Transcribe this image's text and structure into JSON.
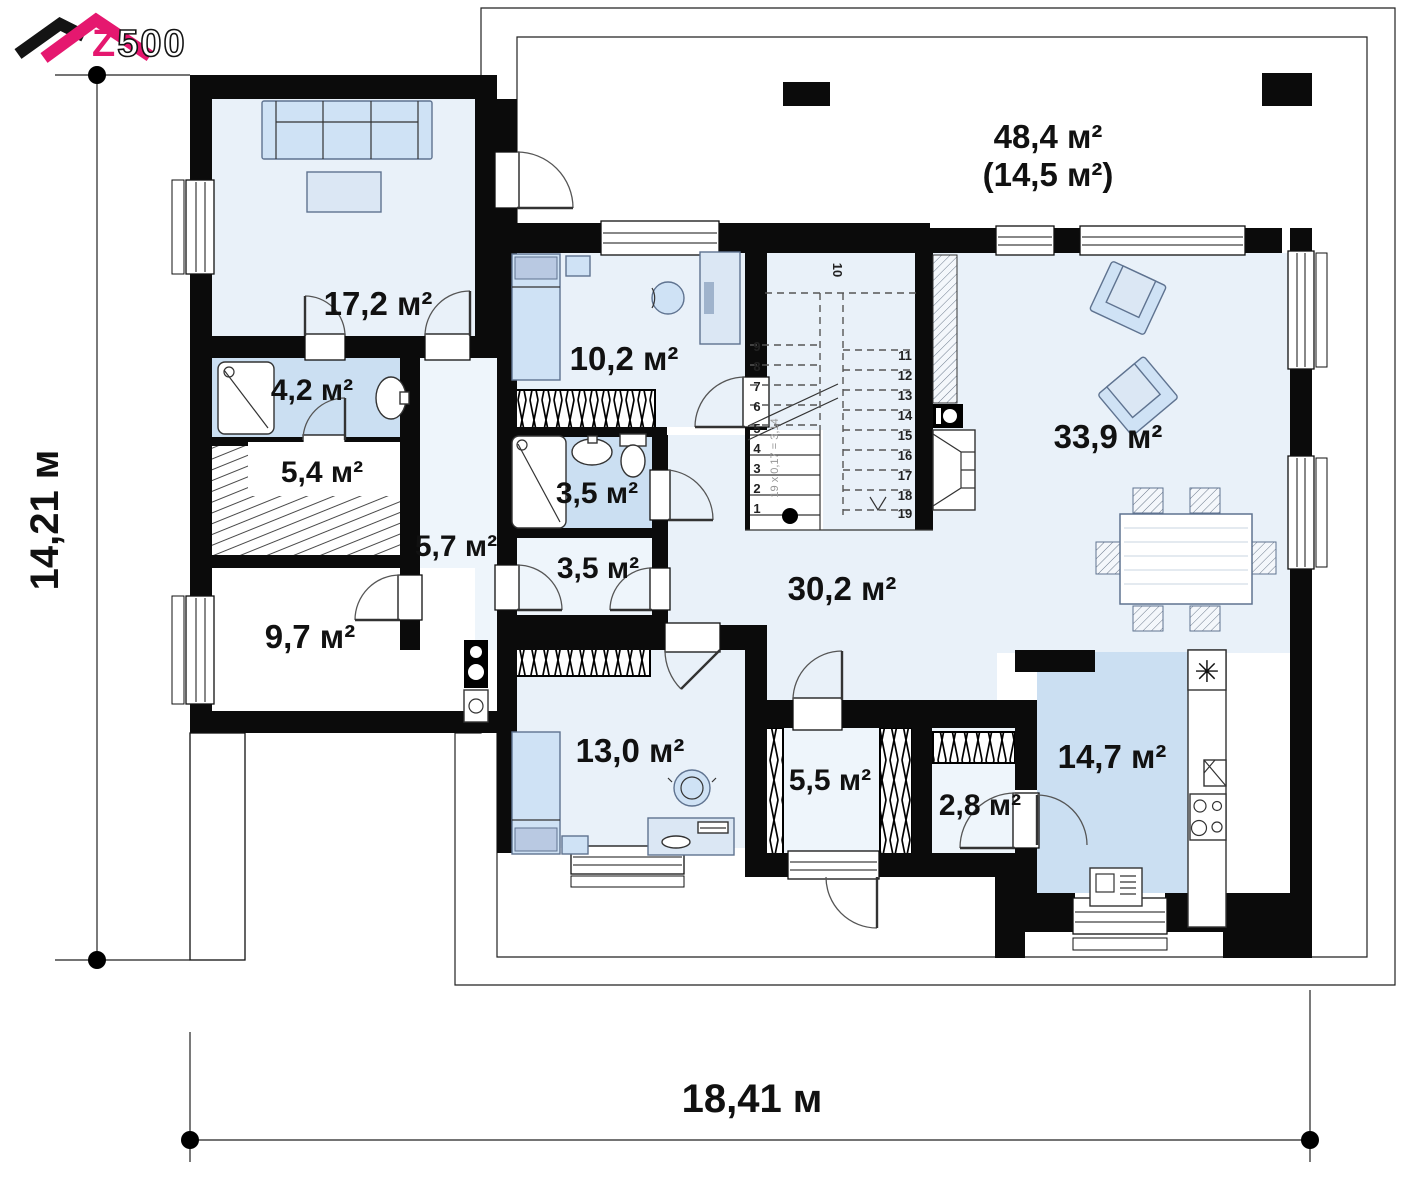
{
  "logo": {
    "brand_z": "Z",
    "brand_rest": "500"
  },
  "plan": {
    "terrace": {
      "area": "48,4 м²",
      "area_in_brackets": "(14,5 м²)"
    },
    "rooms": {
      "room_17_2": {
        "area": "17,2 м²"
      },
      "bath_4_2": {
        "area": "4,2 м²"
      },
      "tech_5_4": {
        "area": "5,4 м²"
      },
      "corridor_5_7": {
        "area": "5,7 м²"
      },
      "room_9_7": {
        "area": "9,7 м²"
      },
      "bedroom_10_2": {
        "area": "10,2 м²"
      },
      "bath_3_5": {
        "area": "3,5 м²"
      },
      "hall_3_5": {
        "area": "3,5 м²"
      },
      "bedroom_13_0": {
        "area": "13,0 м²"
      },
      "hall_30_2": {
        "area": "30,2 м²"
      },
      "living_33_9": {
        "area": "33,9 м²"
      },
      "wardrobe_5_5": {
        "area": "5,5 м²"
      },
      "pantry_2_8": {
        "area": "2,8 м²"
      },
      "kitchen_14_7": {
        "area": "14,7 м²"
      }
    },
    "stairs": {
      "formula": "19 x 0,17 = 3,14",
      "numbers": [
        "1",
        "2",
        "3",
        "4",
        "5",
        "6",
        "7",
        "8",
        "9",
        "10",
        "11",
        "12",
        "13",
        "14",
        "15",
        "16",
        "17",
        "18",
        "19"
      ]
    },
    "dimensions": {
      "width": "18,41 м",
      "height": "14,21 м"
    },
    "kitchen_icons": {
      "sink": "✳"
    }
  }
}
